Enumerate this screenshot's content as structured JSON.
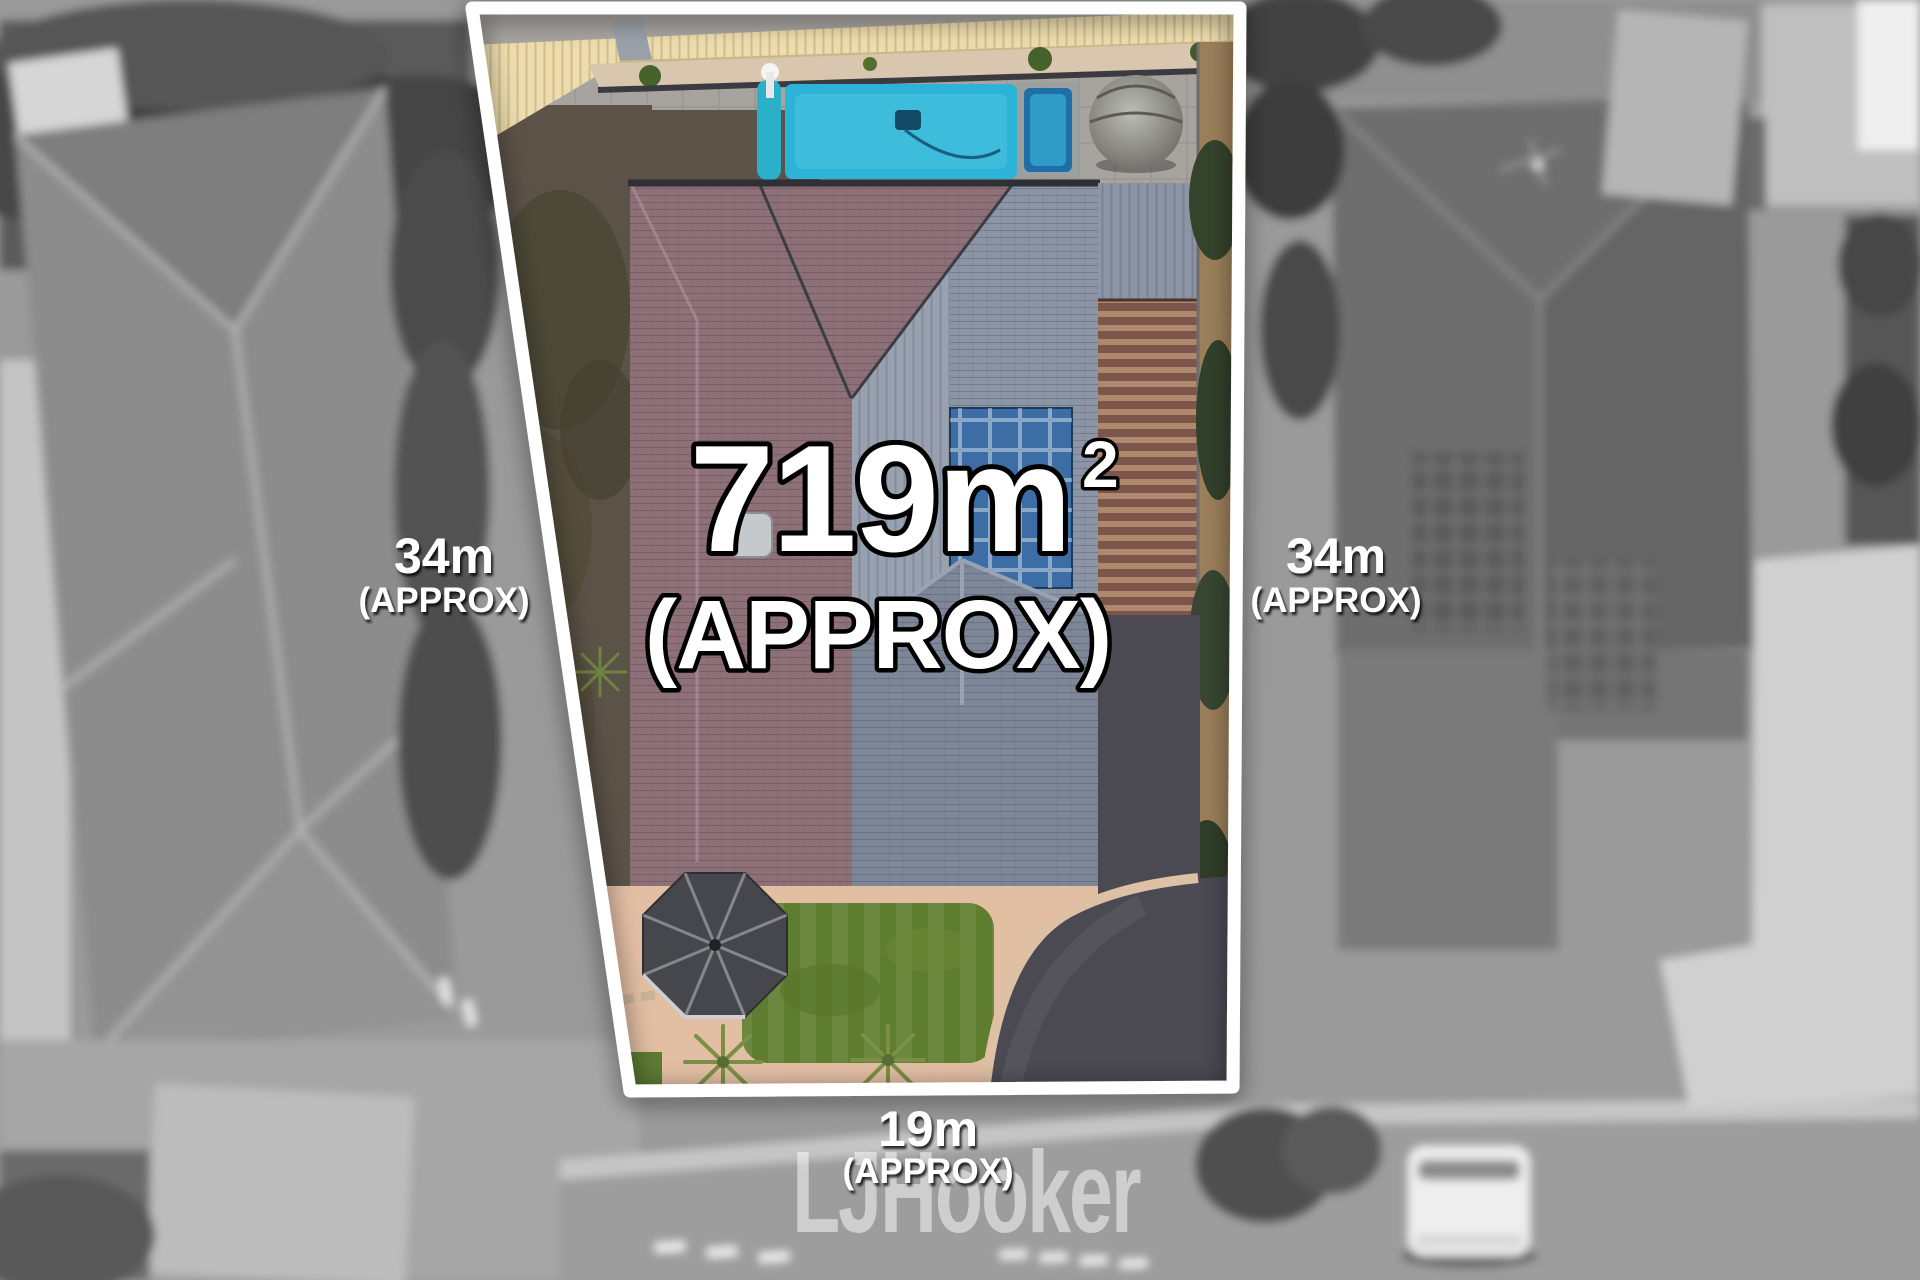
{
  "overlay": {
    "land_area": {
      "value": "719m",
      "superscript": "2",
      "qualifier": "(APPROX)"
    },
    "boundaries": {
      "left": {
        "length": "34m",
        "qualifier": "(APPROX)"
      },
      "right": {
        "length": "34m",
        "qualifier": "(APPROX)"
      },
      "front": {
        "length": "19m",
        "qualifier": "(APPROX)"
      }
    },
    "watermark": "LJHooker"
  },
  "scene": {
    "description": "Aerial drone photograph of a residential allotment for sale; featured parcel shown in colour inside a white boundary outline, neighbouring properties desaturated and blurred",
    "features": [
      "swimming-pool",
      "spa",
      "main-house-roof",
      "solar-panels",
      "pergola",
      "gazebo-roof",
      "lawn",
      "driveway",
      "neighbour-house-left",
      "neighbour-house-right",
      "street",
      "parked-van"
    ]
  },
  "palette": {
    "boundary_line": "#ffffff",
    "pool_water": "#2cb4d8",
    "spa_water": "#2f9cc7",
    "main_roof": "#8d7078",
    "secondary_roof": "#8c95a5",
    "solar_panel": "#3d6da5",
    "lawn": "#5f7d2e",
    "driveway": "#4b4a53",
    "gravel_path": "#e2bea3",
    "cream_roof": "#ecdcae",
    "overlay_text": "#ffffff",
    "overlay_text_outline": "#000000"
  }
}
